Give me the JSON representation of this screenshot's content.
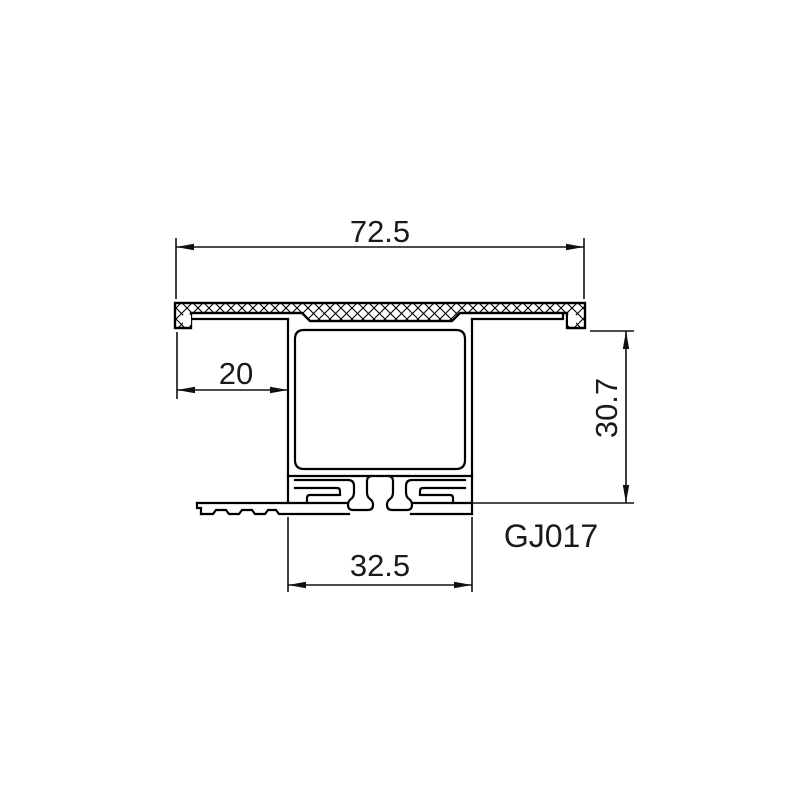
{
  "drawing": {
    "part_number": "GJ017",
    "dimensions": {
      "top_width": "72.5",
      "left_flange": "20",
      "right_height": "30.7",
      "bottom_width": "32.5"
    },
    "colors": {
      "line": "#000000",
      "text": "#1a1a1a",
      "background": "#ffffff"
    }
  }
}
